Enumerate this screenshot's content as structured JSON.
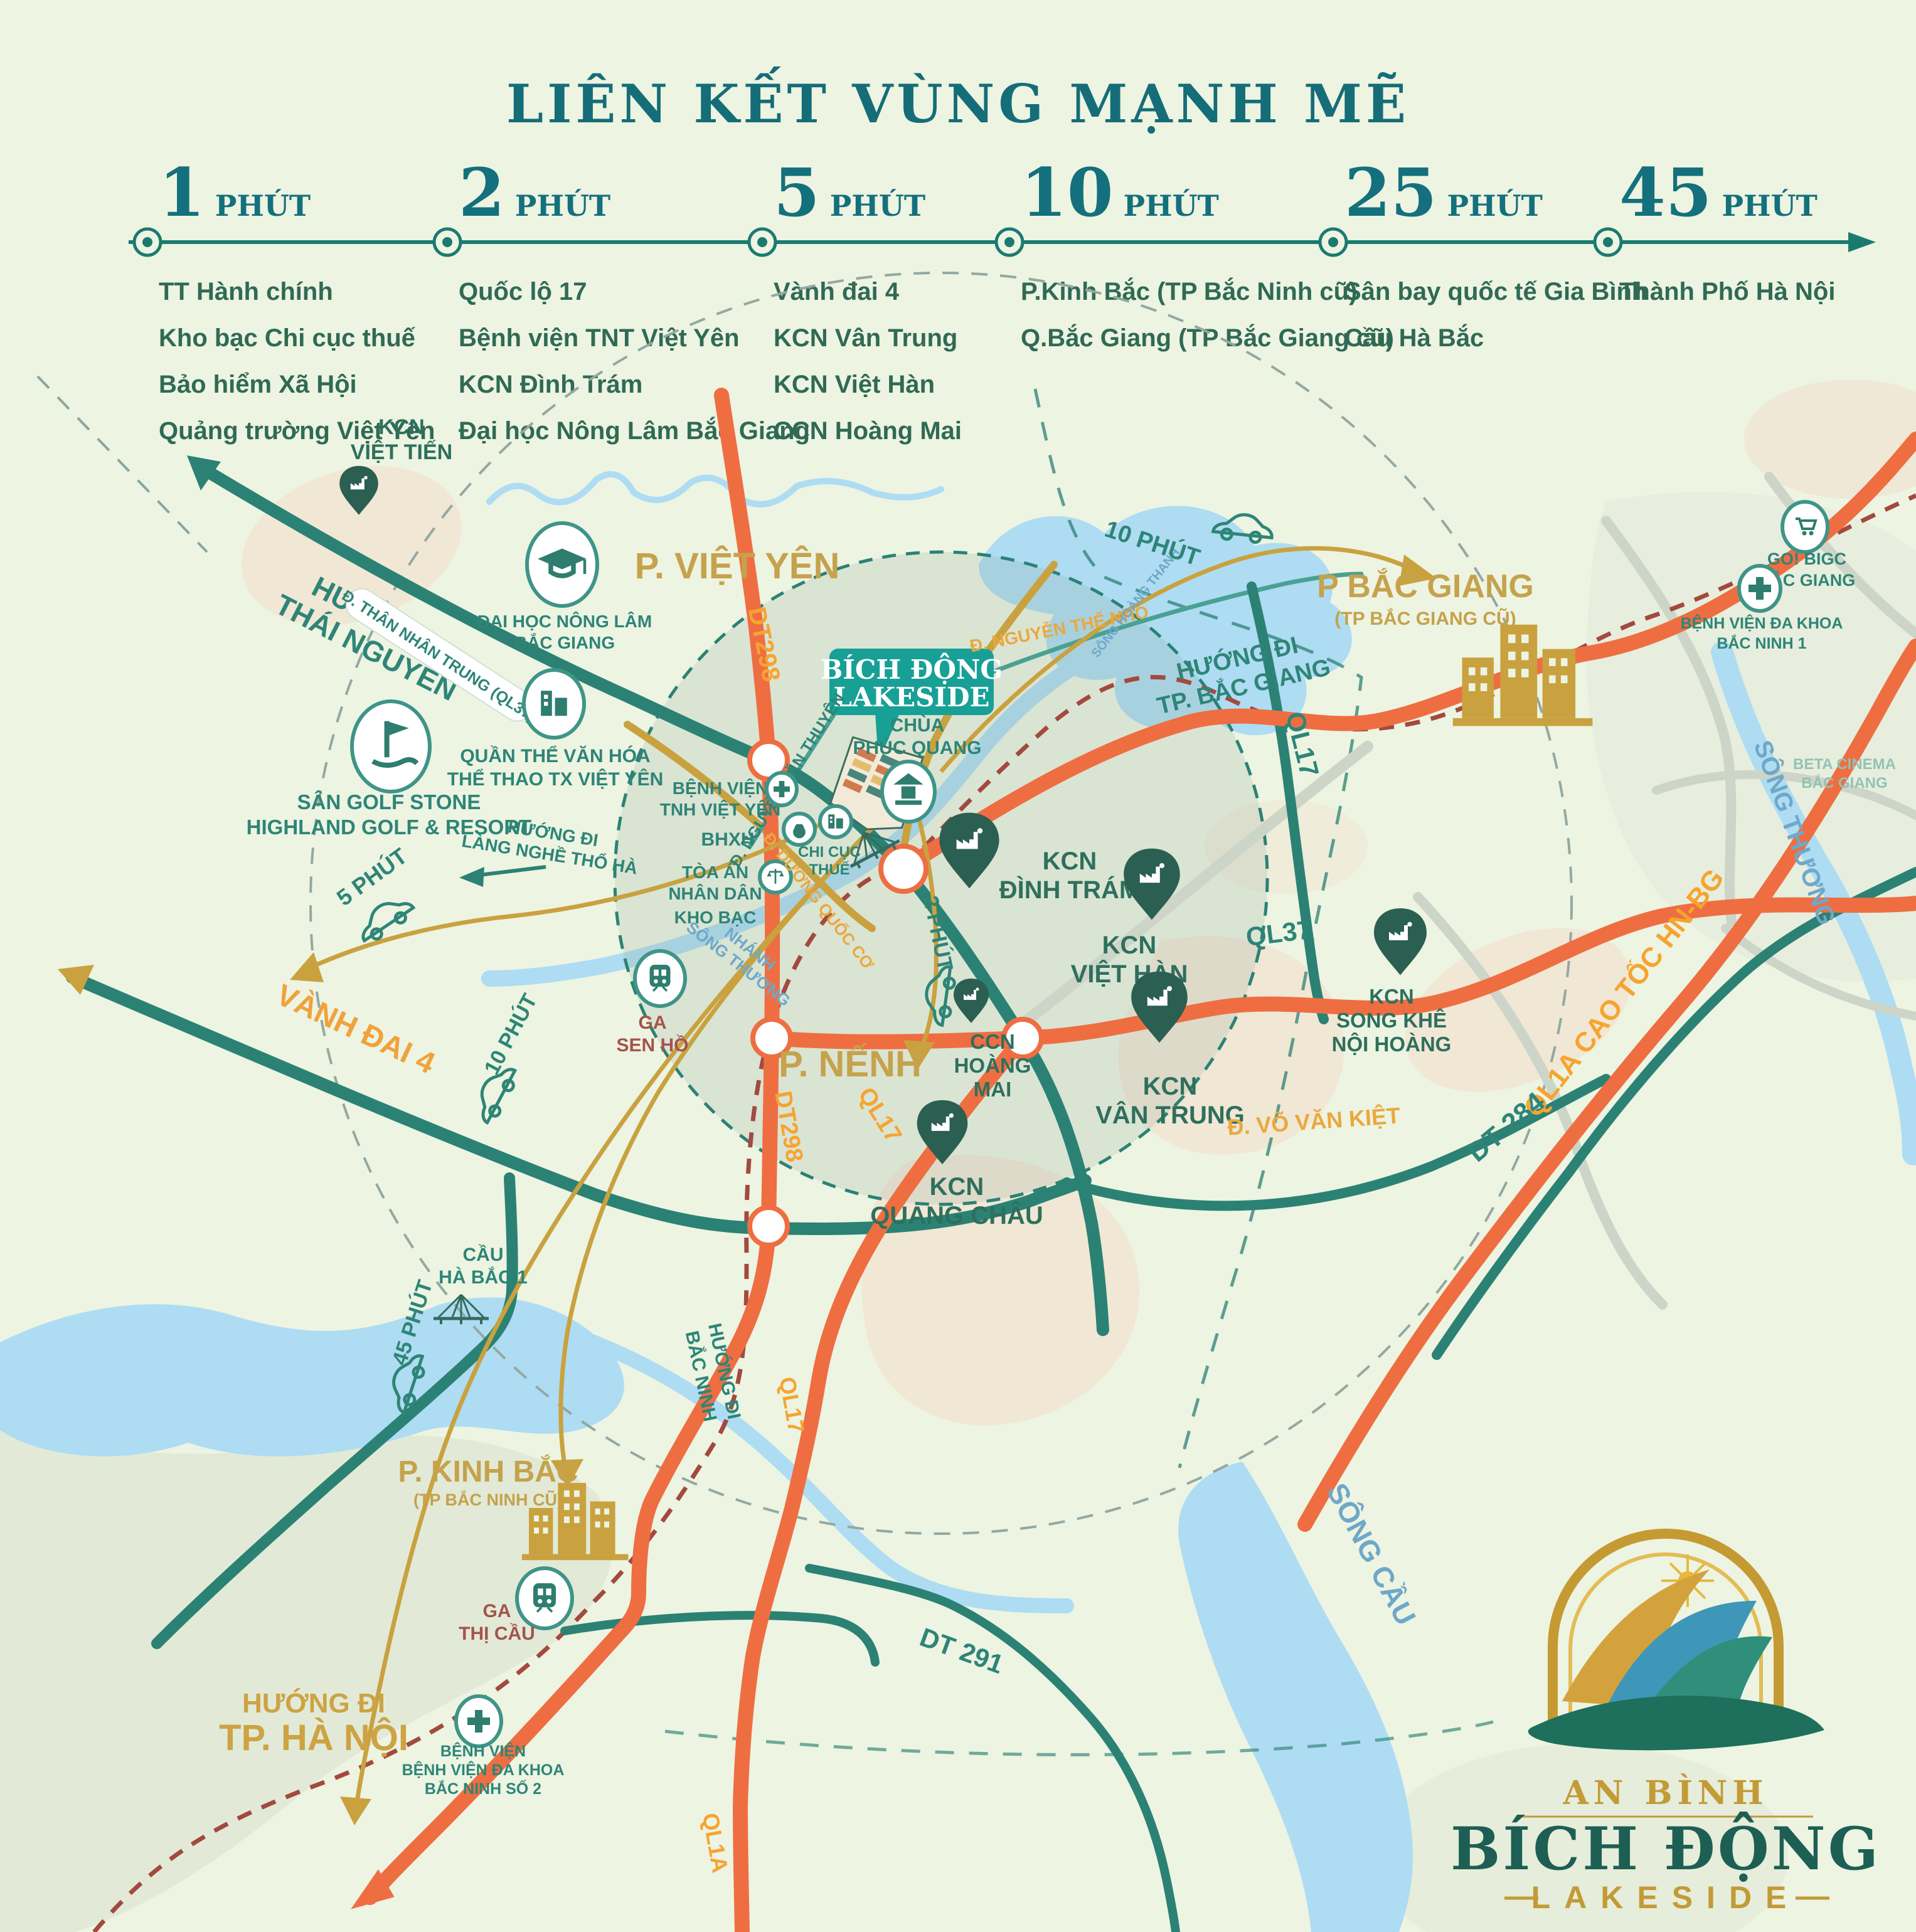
{
  "title": "LIÊN KẾT VÙNG MẠNH MẼ",
  "timeline": {
    "columns": [
      {
        "number": "1",
        "unit": "PHÚT",
        "items": [
          "TT Hành chính",
          "Kho bạc Chi cục thuế",
          "Bảo hiểm Xã Hội",
          "Quảng trường Việt Yên"
        ]
      },
      {
        "number": "2",
        "unit": "PHÚT",
        "items": [
          "Quốc lộ 17",
          "Bệnh viện TNT Việt Yên",
          "KCN Đình Trám",
          "Đại học Nông Lâm Bắc Giang"
        ]
      },
      {
        "number": "5",
        "unit": "PHÚT",
        "items": [
          "Vành đai 4",
          "KCN Vân Trung",
          "KCN Việt Hàn",
          "CCN Hoàng Mai"
        ]
      },
      {
        "number": "10",
        "unit": "PHÚT",
        "items": [
          "P.Kinh Bắc (TP Bắc Ninh cũ)",
          "Q.Bắc Giang (TP Bắc Giang cũ)"
        ]
      },
      {
        "number": "25",
        "unit": "PHÚT",
        "items": [
          "Sân bay quốc tế Gia Bình",
          "Cầu Hà Bắc"
        ]
      },
      {
        "number": "45",
        "unit": "PHÚT",
        "items": [
          "Thành Phố Hà Nội"
        ]
      }
    ]
  },
  "map": {
    "kcn_viet_tien_1": "KCN",
    "kcn_viet_tien_2": "VIỆT TIẾN",
    "p_viet_yen": "P. VIỆT YÊN",
    "dh_nong_lam_1": "ĐẠI HỌC NÔNG LÂM",
    "dh_nong_lam_2": "BẮC GIANG",
    "huong_thai_nguyen_1": "HƯỚNG ĐI",
    "huong_thai_nguyen_2": "THÁI NGUYÊN",
    "than_nhan_trung": "Đ. THÂN NHÂN TRUNG (QL37)",
    "dt298_a": "DT298",
    "dt298_b": "DT298",
    "badge_1": "BÍCH ĐỘNG",
    "badge_2": "LAKESIDE",
    "nguyen_the_nho": "Đ. NGUYỄN THẾ NHO",
    "nguyen_van_thuyen": "Đ. NGUYỄN VĂN THUYÊN",
    "song_hoang_thanh": "SÔNG HOÀNG THANH",
    "t10_phut_top": "10 PHÚT",
    "p_bac_giang": "P BẮC GIANG",
    "p_bac_giang_sub": "(TP BẮC GIANG CŨ)",
    "go_bigc_1": "GO! BIGC",
    "go_bigc_2": "BẮC GIANG",
    "bv_bn1_1": "BỆNH VIỆN ĐA KHOA",
    "bv_bn1_2": "BẮC NINH 1",
    "beta_1": "BETA CINEMA",
    "beta_2": "BẮC GIANG",
    "huong_bg_1": "HƯỚNG ĐI",
    "huong_bg_2": "TP. BẮC GIANG",
    "ql17_a": "QL17",
    "ql17_b": "QL17",
    "ql17_c": "QL17",
    "ql37_a": "QL37",
    "ql1a_ct": "QL1A CAO TỐC HN-BG",
    "ql1a": "QL1A",
    "song_thuong": "SÔNG THƯƠNG",
    "san_golf_1": "SÂN GOLF STONE",
    "san_golf_2": "HIGHLAND GOLF & RESORT",
    "quan_the_1": "QUẦN THỂ VĂN HÓA",
    "quan_the_2": "THỂ THAO TX VIỆT YÊN",
    "chua_1": "CHÙA",
    "chua_2": "PHÚC QUANG",
    "bv_tnh_1": "BỆNH VIỆN",
    "bv_tnh_2": "TNH VIỆT YÊN",
    "bhxh": "BHXH",
    "toa_an_1": "TÒA ÁN",
    "toa_an_2": "NHÂN DÂN",
    "kho_bac": "KHO BẠC",
    "chi_cuc_1": "CHI CỤC",
    "chi_cuc_2": "THUẾ",
    "duong_quoc_co": "Đ. DƯƠNG QUỐC CƠ",
    "nhanh_st_1": "NHÁNH",
    "nhanh_st_2": "SÔNG THƯƠNG",
    "ga_sen_ho_1": "GA",
    "ga_sen_ho_2": "SEN HỒ",
    "t2_phut": "2 PHÚT",
    "t5_phut": "5 PHÚT",
    "t10_phut_left": "10 PHÚT",
    "t45_phut": "45 PHÚT",
    "dinh_tram_1": "KCN",
    "dinh_tram_2": "ĐÌNH TRÁM",
    "viet_han_1": "KCN",
    "viet_han_2": "VIỆT HÀN",
    "van_trung_1": "KCN",
    "van_trung_2": "VÂN TRUNG",
    "hoang_mai_1": "CCN",
    "hoang_mai_2": "HOÀNG",
    "hoang_mai_3": "MAI",
    "song_khe_1": "KCN",
    "song_khe_2": "SONG KHÊ",
    "song_khe_3": "NỘI HOÀNG",
    "vo_van_kiet": "Đ. VÕ VĂN KIỆT",
    "dt284": "DT 284",
    "vanh_dai_4": "VÀNH ĐAI 4",
    "lang_nghe_1": "HƯỚNG ĐI",
    "lang_nghe_2": "LÀNG NGHỀ THỔ HÀ",
    "p_nenh": "P. NẾNH",
    "quang_chau_1": "KCN",
    "quang_chau_2": "QUANG CHÂU",
    "cau_ha_bac_1": "CẦU",
    "cau_ha_bac_2": "HÀ BẮC 1",
    "huong_bn_1": "HƯỚNG ĐI",
    "huong_bn_2": "BẮC NINH",
    "p_kinh_bac": "P. KINH BẮC",
    "p_kinh_bac_sub": "(TP BẮC NINH CŨ)",
    "ga_thi_cau_1": "GA",
    "ga_thi_cau_2": "THỊ CẦU",
    "huong_hn_1": "HƯỚNG ĐI",
    "huong_hn_2": "TP. HÀ NỘI",
    "bv_bn2_1": "BỆNH VIỆN",
    "bv_bn2_2": "BỆNH VIỆN ĐA KHOA",
    "bv_bn2_3": "BẮC NINH SỐ 2",
    "dt291": "DT 291",
    "song_cau": "SÔNG CẦU"
  },
  "logo": {
    "brand": "AN BÌNH",
    "name": "BÍCH ĐỘNG",
    "tagline": "LAKESIDE"
  },
  "colors": {
    "teal": "#156d78",
    "road_orange": "#ee6e42",
    "road_teal": "#2b8274",
    "gold": "#c9a23f",
    "river": "#aedcf3",
    "pin_green": "#2b5f52",
    "badge_teal": "#18a096"
  }
}
